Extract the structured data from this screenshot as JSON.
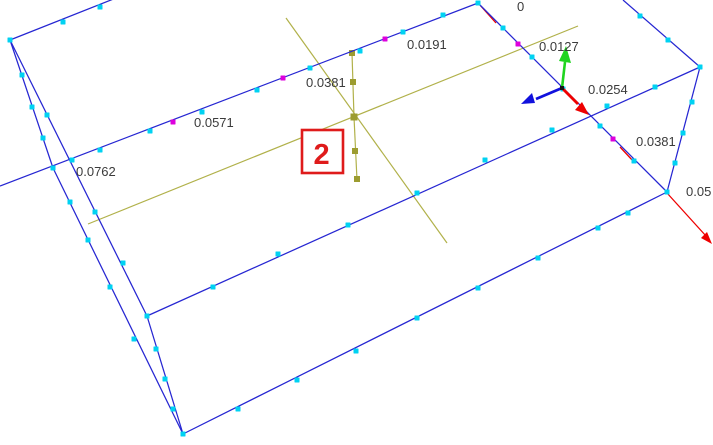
{
  "viewport": {
    "description": "3D CAD wireframe viewport of a rectangular slab with keypoint markers, working-plane axes and coordinate triad",
    "width": 713,
    "height": 445,
    "background": "#ffffff"
  },
  "colors": {
    "edge_blue": "#2626d2",
    "node_cyan": "#00d2f2",
    "node_magenta": "#dd00dd",
    "workplane_olive": "#b1b14a",
    "workplane_marker": "#9c9c30",
    "axis_red": "#ee0000",
    "triad_green": "#1fd41f",
    "triad_blue": "#1111dd",
    "ruler_text": "#3b3b3b",
    "badge_red": "#df1b1b"
  },
  "area_badge": {
    "label": "2",
    "x": 302,
    "y": 130,
    "w": 41,
    "h": 43
  },
  "ruler_labels": [
    {
      "text": "0",
      "x": 517,
      "y": 11
    },
    {
      "text": "0.0127",
      "x": 539,
      "y": 51
    },
    {
      "text": "0.0254",
      "x": 588,
      "y": 94
    },
    {
      "text": "0.0381",
      "x": 636,
      "y": 146
    },
    {
      "text": "0.05",
      "x": 686,
      "y": 196
    },
    {
      "text": "0.0191",
      "x": 407,
      "y": 49
    },
    {
      "text": "0.0381",
      "x": 306,
      "y": 87
    },
    {
      "text": "0.0571",
      "x": 194,
      "y": 127
    },
    {
      "text": "0.0762",
      "x": 76,
      "y": 176
    }
  ],
  "geometry": {
    "edges": [
      [
        10,
        40,
        116,
        -2
      ],
      [
        10,
        40,
        53,
        168
      ],
      [
        53,
        168,
        183,
        434
      ],
      [
        10,
        40,
        147,
        316
      ],
      [
        147,
        316,
        183,
        434
      ],
      [
        147,
        316,
        700,
        67
      ],
      [
        183,
        434,
        667,
        192
      ],
      [
        667,
        192,
        700,
        67
      ],
      [
        700,
        67,
        623,
        0
      ],
      [
        478,
        3,
        667,
        192
      ],
      [
        478,
        3,
        0,
        186
      ]
    ],
    "red_axis_segments": [
      [
        479,
        4,
        496,
        23
      ],
      [
        620,
        147,
        634,
        162
      ],
      [
        667,
        193,
        706,
        236
      ]
    ],
    "red_axis_head": "712,244 701,238 707,232",
    "workplane_lines": [
      [
        286,
        18,
        447,
        243
      ],
      [
        88,
        224,
        578,
        26
      ],
      [
        352,
        53,
        354,
        117
      ],
      [
        354,
        117,
        357,
        180
      ]
    ],
    "workplane_markers": [
      [
        352,
        53,
        6
      ],
      [
        353,
        82,
        6
      ],
      [
        354,
        117,
        7
      ],
      [
        355,
        151,
        6
      ],
      [
        357,
        179,
        6
      ]
    ],
    "nodes_cyan": [
      [
        443,
        15
      ],
      [
        403,
        32
      ],
      [
        360,
        51
      ],
      [
        310,
        68
      ],
      [
        257,
        90
      ],
      [
        202,
        112
      ],
      [
        150,
        131
      ],
      [
        100,
        150
      ],
      [
        503,
        28
      ],
      [
        532,
        57
      ],
      [
        563,
        89
      ],
      [
        600,
        126
      ],
      [
        634,
        161
      ],
      [
        478,
        3
      ],
      [
        10,
        40
      ],
      [
        667,
        192
      ],
      [
        700,
        67
      ],
      [
        183,
        434
      ],
      [
        147,
        316
      ],
      [
        63,
        22
      ],
      [
        100,
        7
      ],
      [
        640,
        16
      ],
      [
        668,
        40
      ],
      [
        692,
        102
      ],
      [
        683,
        133
      ],
      [
        675,
        163
      ],
      [
        213,
        287
      ],
      [
        278,
        254
      ],
      [
        348,
        225
      ],
      [
        417,
        193
      ],
      [
        485,
        160
      ],
      [
        552,
        130
      ],
      [
        607,
        106
      ],
      [
        655,
        87
      ],
      [
        238,
        409
      ],
      [
        297,
        380
      ],
      [
        356,
        351
      ],
      [
        417,
        318
      ],
      [
        478,
        288
      ],
      [
        538,
        258
      ],
      [
        598,
        228
      ],
      [
        628,
        213
      ],
      [
        22,
        75
      ],
      [
        32,
        107
      ],
      [
        43,
        138
      ],
      [
        70,
        202
      ],
      [
        88,
        240
      ],
      [
        110,
        287
      ],
      [
        134,
        339
      ],
      [
        47,
        115
      ],
      [
        95,
        212
      ],
      [
        123,
        263
      ],
      [
        156,
        349
      ],
      [
        165,
        379
      ],
      [
        173,
        409
      ],
      [
        53,
        168
      ],
      [
        72,
        160
      ]
    ],
    "nodes_magenta": [
      [
        385,
        39
      ],
      [
        283,
        78
      ],
      [
        173,
        122
      ],
      [
        518,
        44
      ],
      [
        613,
        139
      ]
    ]
  },
  "triad": {
    "origin": [
      562,
      88
    ],
    "green_shaft": [
      562,
      88,
      565,
      62
    ],
    "green_head": "566,46 571,63 559,61",
    "blue_shaft": [
      562,
      88,
      536,
      99
    ],
    "blue_head": "521,104 532,93 535,103",
    "red_shaft": [
      562,
      88,
      578,
      104
    ],
    "red_head": "589,115 575,110 582,102"
  }
}
